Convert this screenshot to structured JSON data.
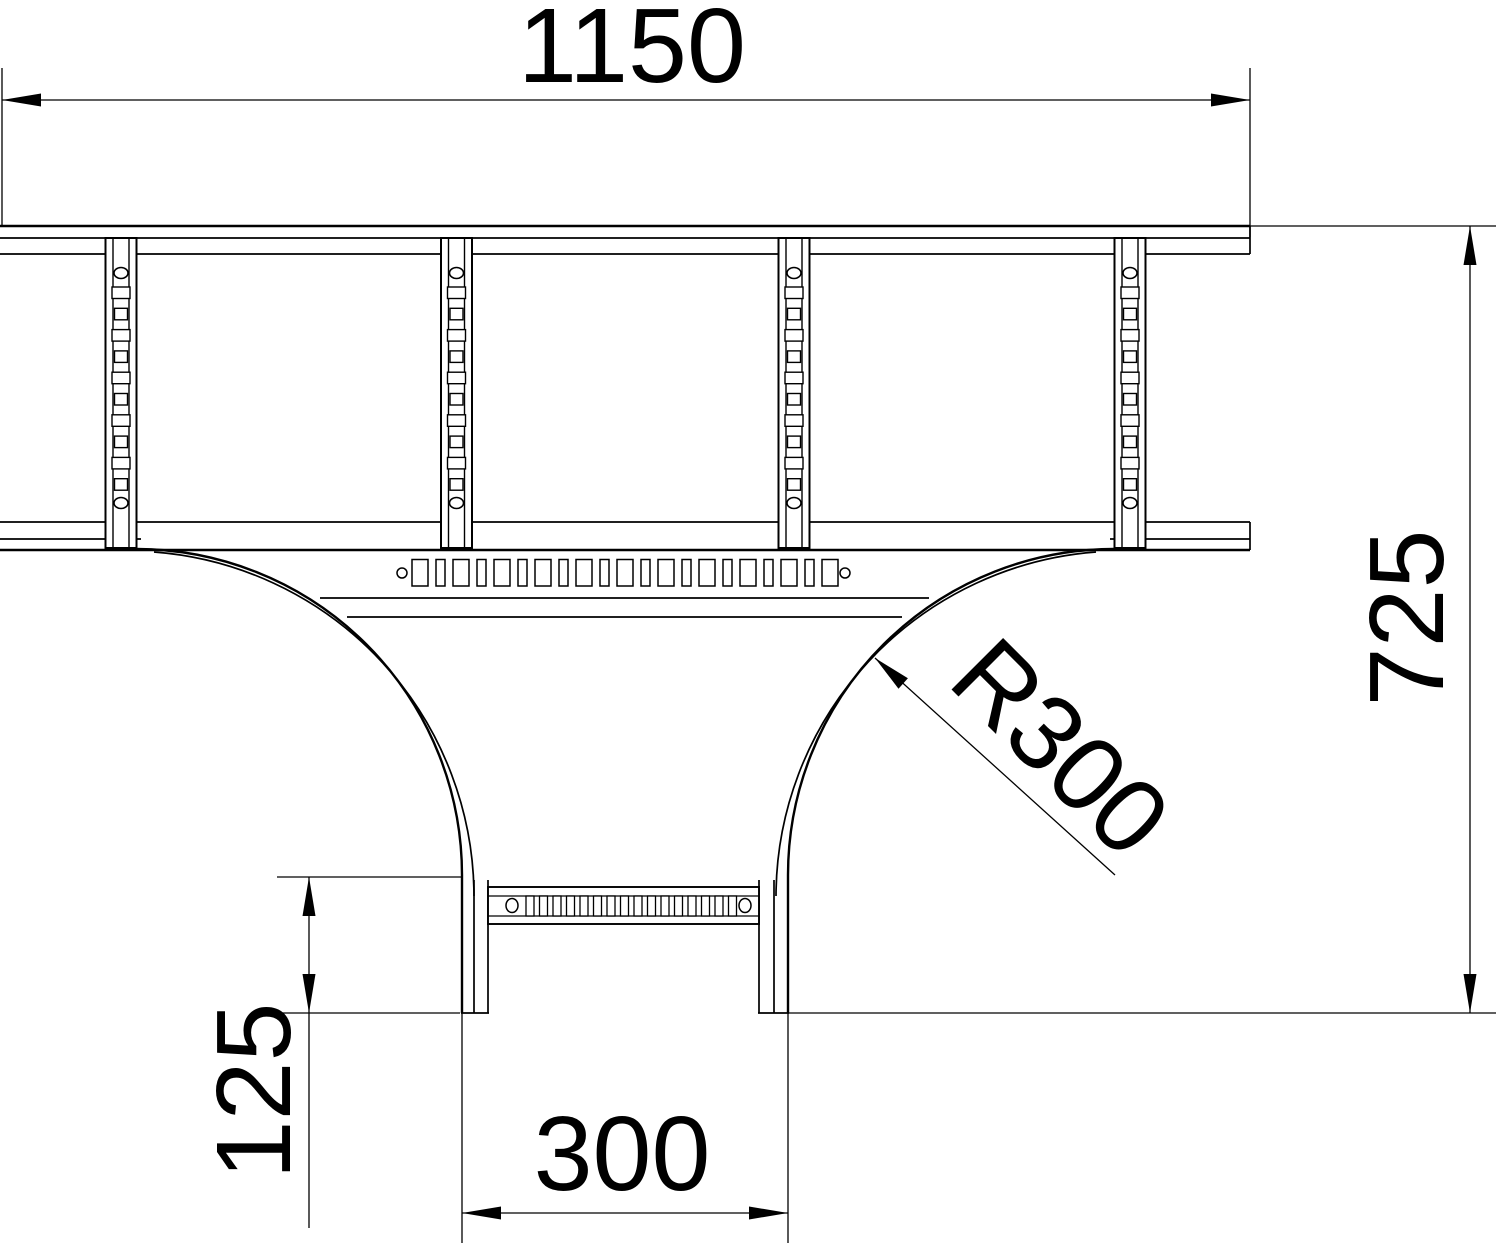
{
  "page": {
    "title": "Cable ladder T-piece - dimensional drawing (plan view)",
    "background": "#ffffff",
    "line_color": "#000000"
  },
  "dimensions": {
    "main_length": {
      "label": "1150",
      "meaning": "overall length of main ladder run"
    },
    "overall_depth": {
      "label": "725",
      "meaning": "depth from main run top edge to branch end"
    },
    "bend_radius": {
      "label": "R300",
      "meaning": "fillet bend radius of branch transition"
    },
    "branch_tangent": {
      "label": "125",
      "meaning": "straight tangent length of branch outlet"
    },
    "branch_width": {
      "label": "300",
      "meaning": "branch outlet width"
    }
  },
  "drawing": {
    "main_rungs": {
      "centers": [
        121,
        456.5,
        794,
        1130
      ],
      "top": 238,
      "bottom": 548,
      "outer_width": 31,
      "inner_half": 8,
      "hole_top_y": 273,
      "hole_bottom_y": 503,
      "hole_rx": 7,
      "hole_ry": 5.5,
      "slot_count": 10,
      "slot_y0": 287,
      "slot_pitch": 21.3,
      "slot_h": 11.5,
      "slot_w_wide": 18,
      "slot_w_narrow": 13
    },
    "junction_plate": {
      "slot_count": 21,
      "x0": 412,
      "y": 559.5,
      "h": 26.5,
      "w_wide": 16,
      "w_narrow": 9,
      "gap": 8,
      "hole_left_x": 402,
      "hole_right_x": 845,
      "hole_y": 573,
      "hole_r": 5
    },
    "branch_rung": {
      "slot_count": 16,
      "x0": 526,
      "y": 896,
      "h": 20,
      "w": 8,
      "gap": 5.5,
      "hole_left_x": 512,
      "hole_right_x": 745,
      "hole_y": 905.5,
      "hole_rx": 6,
      "hole_ry": 7
    }
  }
}
